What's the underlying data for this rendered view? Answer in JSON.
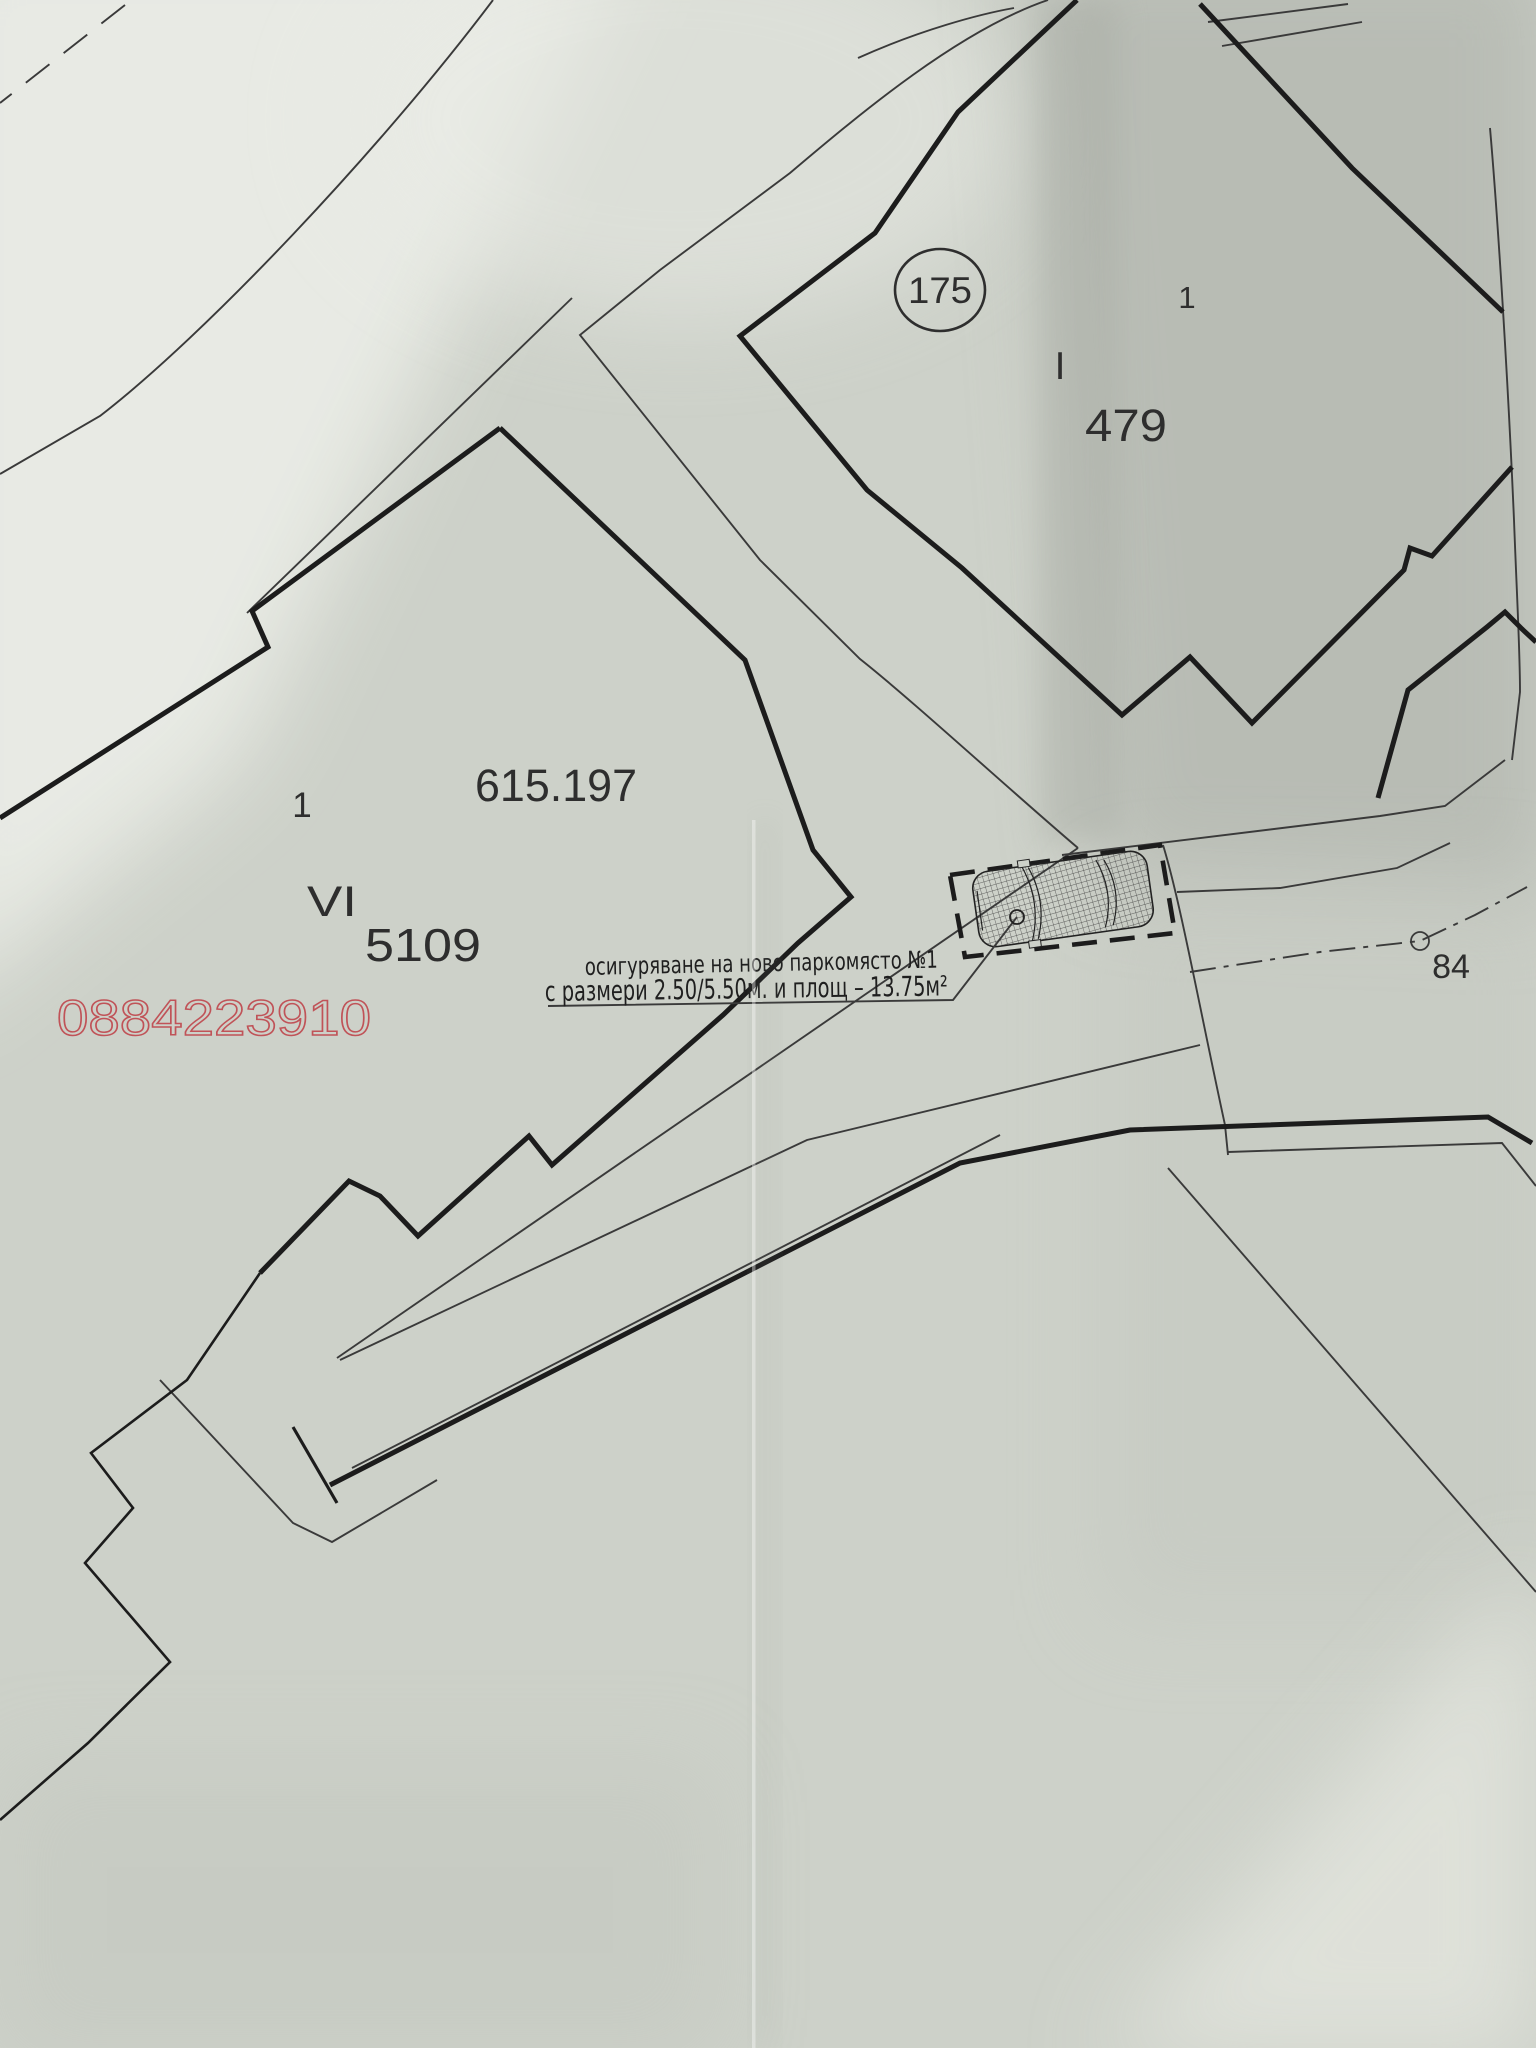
{
  "map": {
    "parcel_top_right": {
      "circle_label": "175",
      "corner_number": "1",
      "roman_numeral": "I",
      "area_number": "479"
    },
    "parcel_main": {
      "elevation_number": "615.197",
      "corner_number": "1",
      "roman_numeral": "VI",
      "parcel_number": "5109"
    },
    "annotation": {
      "line1": "осигуряване на ново паркомясто №1",
      "line2": "с размери 2.50/5.50м. и площ – 13.75м²"
    },
    "watermark_phone": "0884223910",
    "survey_point_label": "84",
    "colors": {
      "ink": "#1c1c1c",
      "thin_line": "#3a3a3a",
      "watermark_red": "#c05358",
      "paper": "#cdd1c9"
    }
  }
}
